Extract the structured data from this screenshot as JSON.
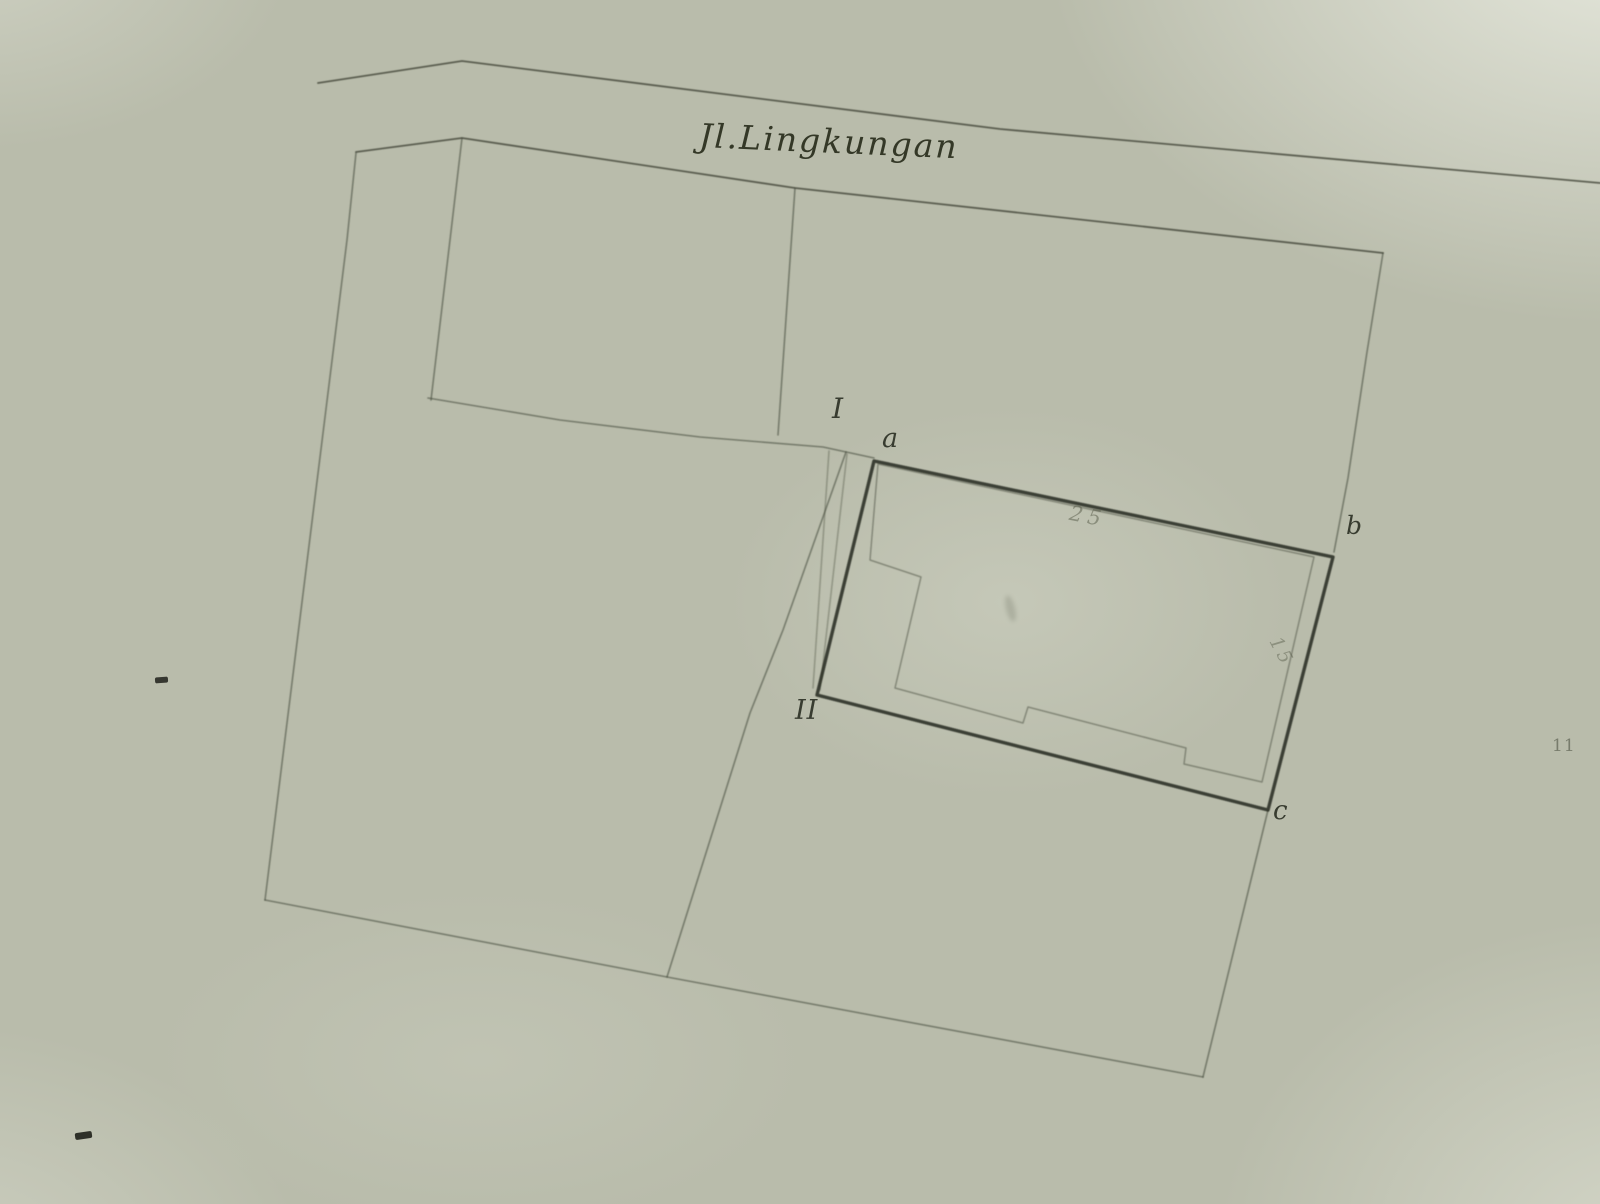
{
  "document": {
    "type": "scanned cadastral sketch map",
    "street": {
      "label": "Jl.Lingkungan"
    },
    "point_labels": {
      "I": "I",
      "a": "a",
      "b": "b",
      "c": "c",
      "II": "II"
    },
    "annotations": {
      "dim_top": "25",
      "dim_right": "15",
      "edge_mark": "11"
    },
    "colors": {
      "paper": "#b9bcab",
      "ink": "#4a4e40",
      "bold_ink": "#2a2d23",
      "faint_ink": "#575b49"
    }
  }
}
